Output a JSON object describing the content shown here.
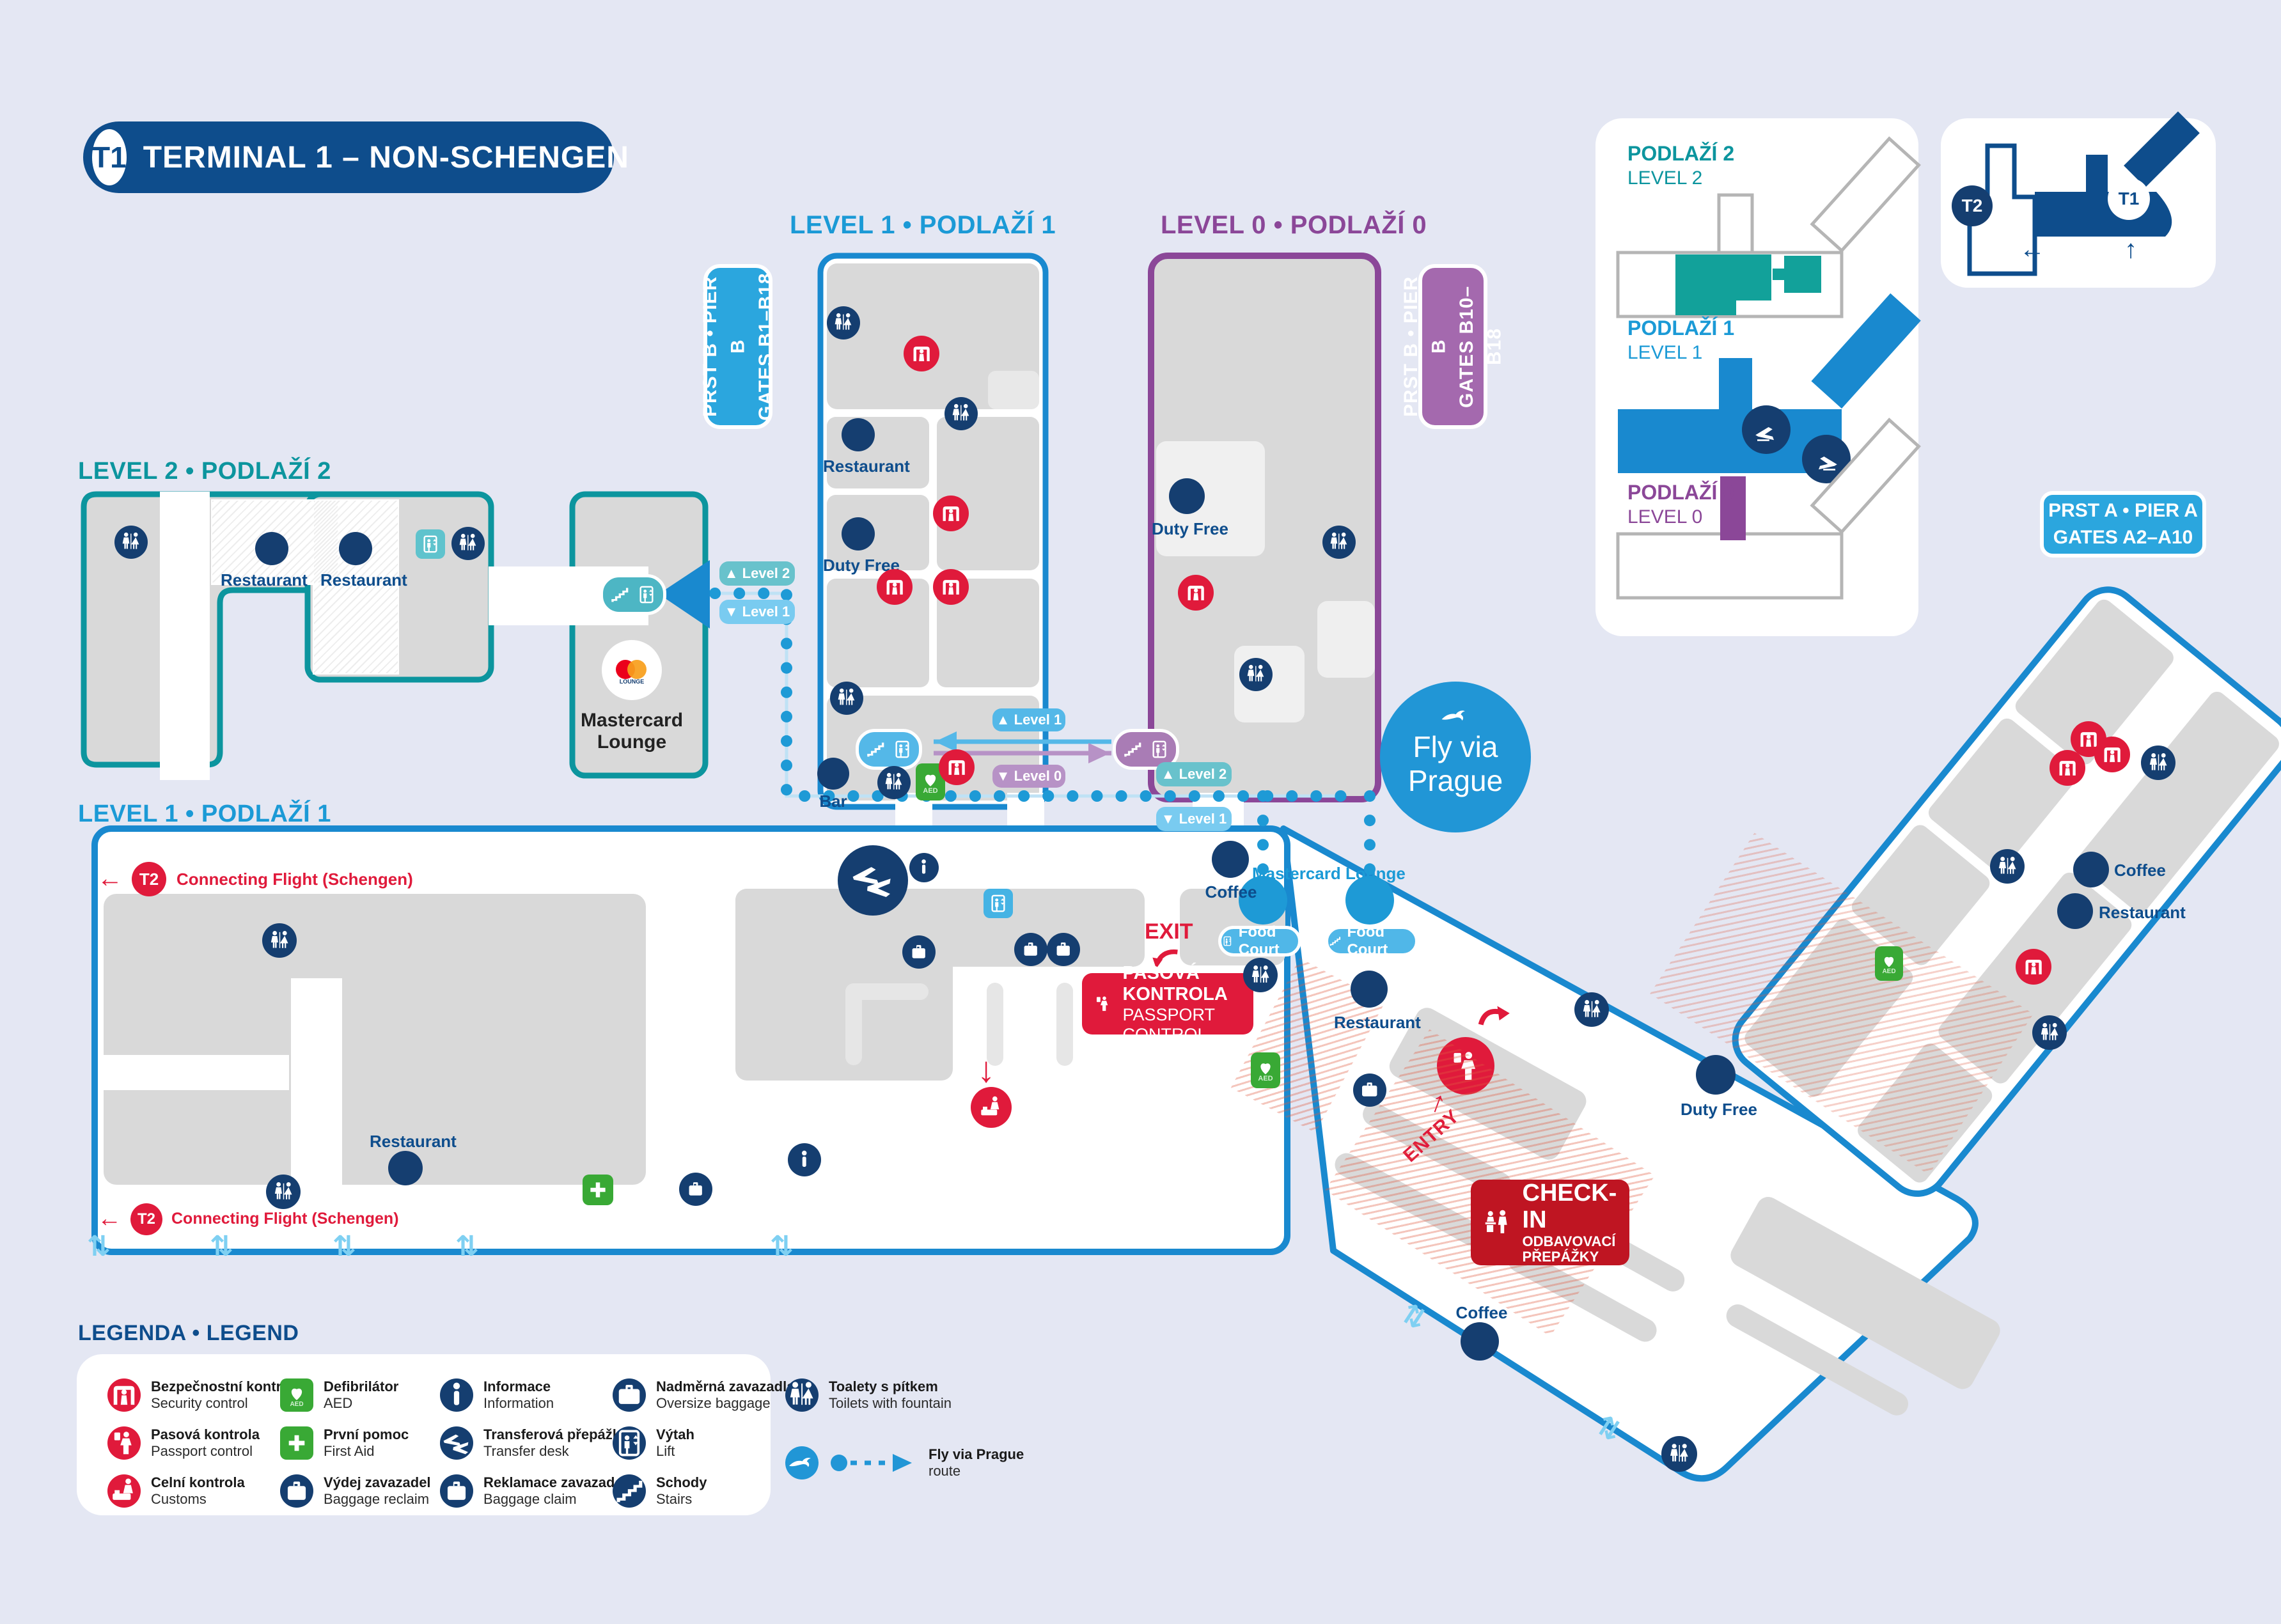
{
  "title": {
    "badge": "T1",
    "text": "TERMINAL 1 – NON-SCHENGEN"
  },
  "headers": {
    "level1_pier": "LEVEL 1  •  PODLAŽÍ 1",
    "level0_pier": "LEVEL 0  •  PODLAŽÍ 0",
    "level2": "LEVEL 2  •  PODLAŽÍ 2",
    "level1_main": "LEVEL 1  •  PODLAŽÍ 1"
  },
  "pier_badges": {
    "pier_b_level1": {
      "line1": "PRST B • PIER B",
      "line2": "GATES B1–B18"
    },
    "pier_b_level0": {
      "line1": "PRST B • PIER B",
      "line2": "GATES B10–B18"
    },
    "pier_a": {
      "line1": "PRST A • PIER A",
      "line2": "GATES A2–A10"
    }
  },
  "minimap": {
    "level2": {
      "title": "PODLAŽÍ 2",
      "subtitle": "LEVEL 2"
    },
    "level1": {
      "title": "PODLAŽÍ 1",
      "subtitle": "LEVEL 1"
    },
    "level0": {
      "title": "PODLAŽÍ 0",
      "subtitle": "LEVEL 0"
    },
    "overview": {
      "t1": "T1",
      "t2": "T2"
    }
  },
  "poi": {
    "restaurant": "Restaurant",
    "duty_free": "Duty Free",
    "coffee": "Coffee",
    "bar": "Bar",
    "food_court": "Food Court",
    "mastercard_lounge": "Mastercard Lounge"
  },
  "signs": {
    "exit": "EXIT",
    "entry": "ENTRY",
    "passport_line1": "PASOVÁ KONTROLA",
    "passport_line2": "PASSPORT CONTROL",
    "checkin_line1": "CHECK-IN",
    "checkin_line2": "ODBAVOVACÍ",
    "checkin_line3": "PŘEPÁŽKY",
    "t2": "T2",
    "connecting": "Connecting Flight (Schengen)"
  },
  "route_tags": {
    "up_level2": "▲ Level 2",
    "down_level1": "▼ Level 1",
    "up_level1": "▲ Level 1",
    "down_level0": "▼ Level 0"
  },
  "fly_via_prague": {
    "line1": "Fly via",
    "line2": "Prague"
  },
  "legend": {
    "title": "LEGENDA  •  LEGEND",
    "items": [
      {
        "cs": "Bezpečnostní kontrola",
        "en": "Security control"
      },
      {
        "cs": "Pasová kontrola",
        "en": "Passport control"
      },
      {
        "cs": "Celní kontrola",
        "en": "Customs"
      },
      {
        "cs": "Defibrilátor",
        "en": "AED"
      },
      {
        "cs": "První pomoc",
        "en": "First Aid"
      },
      {
        "cs": "Výdej zavazadel",
        "en": "Baggage reclaim"
      },
      {
        "cs": "Informace",
        "en": "Information"
      },
      {
        "cs": "Transferová přepážka",
        "en": "Transfer desk"
      },
      {
        "cs": "Reklamace zavazadel",
        "en": "Baggage claim"
      },
      {
        "cs": "Nadměrná zavazadla",
        "en": "Oversize baggage"
      },
      {
        "cs": "Výtah",
        "en": "Lift"
      },
      {
        "cs": "Schody",
        "en": "Stairs"
      },
      {
        "cs": "Toalety s pítkem",
        "en": "Toilets with fountain"
      },
      {
        "cs": "Fly via Prague",
        "en": "route"
      }
    ]
  },
  "colors": {
    "background": "#e4e7f3",
    "brand_navy": "#0e4d8c",
    "icon_navy": "#153e70",
    "map_blue": "#1989cf",
    "light_blue": "#2ba6de",
    "route_blue": "#1e9ad6",
    "teal": "#0c959e",
    "purple": "#8b4798",
    "red": "#e01a3b",
    "checkin_red": "#bf1522",
    "room_gray": "#d9d9d9",
    "green": "#39a935"
  }
}
